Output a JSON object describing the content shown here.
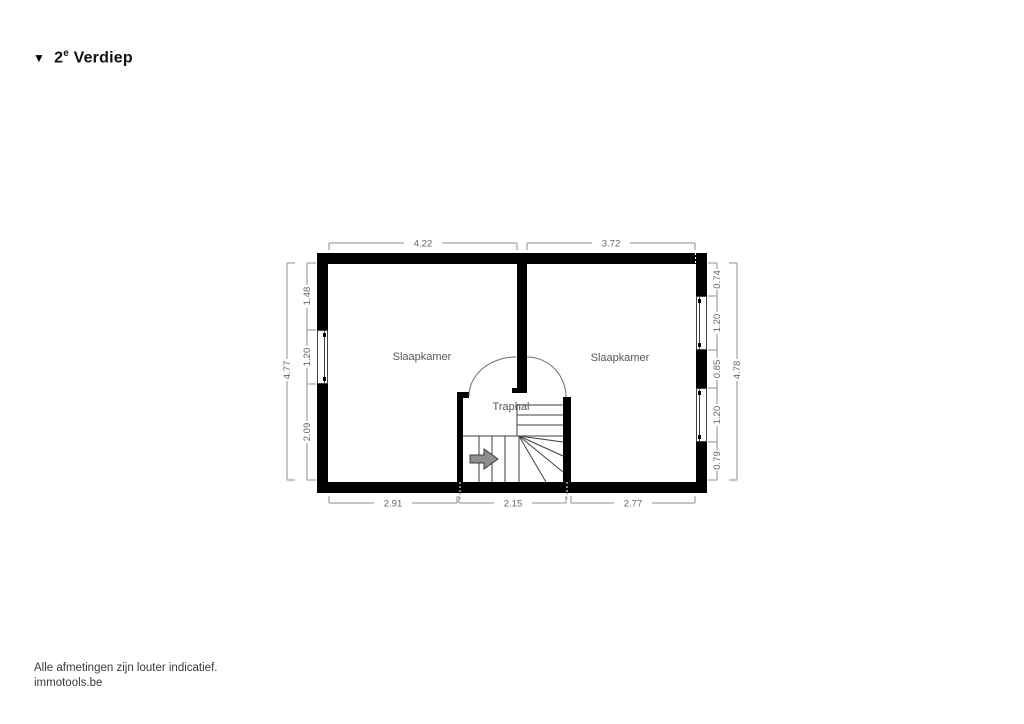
{
  "title": {
    "marker": "▼",
    "number": "2",
    "suffix": "e",
    "name": " Verdiep"
  },
  "rooms": {
    "left_bedroom": "Slaapkamer",
    "right_bedroom": "Slaapkamer",
    "stair_hall": "Traphal"
  },
  "dimensions": {
    "top": [
      "4.22",
      "3.72"
    ],
    "left_outer": "4.77",
    "left_inner": [
      "1.48",
      "1.20",
      "2.09"
    ],
    "right_inner": [
      "0.74",
      "1.20",
      "0.85",
      "1.20",
      "0.79"
    ],
    "right_outer": "4.78",
    "bottom": [
      "2.91",
      "2.15",
      "2.77"
    ]
  },
  "footer": {
    "disclaimer": "Alle afmetingen zijn louter indicatief.",
    "brand": "immotools.be"
  },
  "colors": {
    "wall": "#000000",
    "dim_line": "#8c8c8c",
    "dim_text": "#666666",
    "room_text": "#57575a",
    "stair_line": "#3f3f3f",
    "arc_line": "#6f6f6f",
    "arrow_fill": "#8e8e8e",
    "arrow_stroke": "#3f3f3f",
    "title_text": "#111111",
    "footer_text": "#3a3a3a"
  }
}
